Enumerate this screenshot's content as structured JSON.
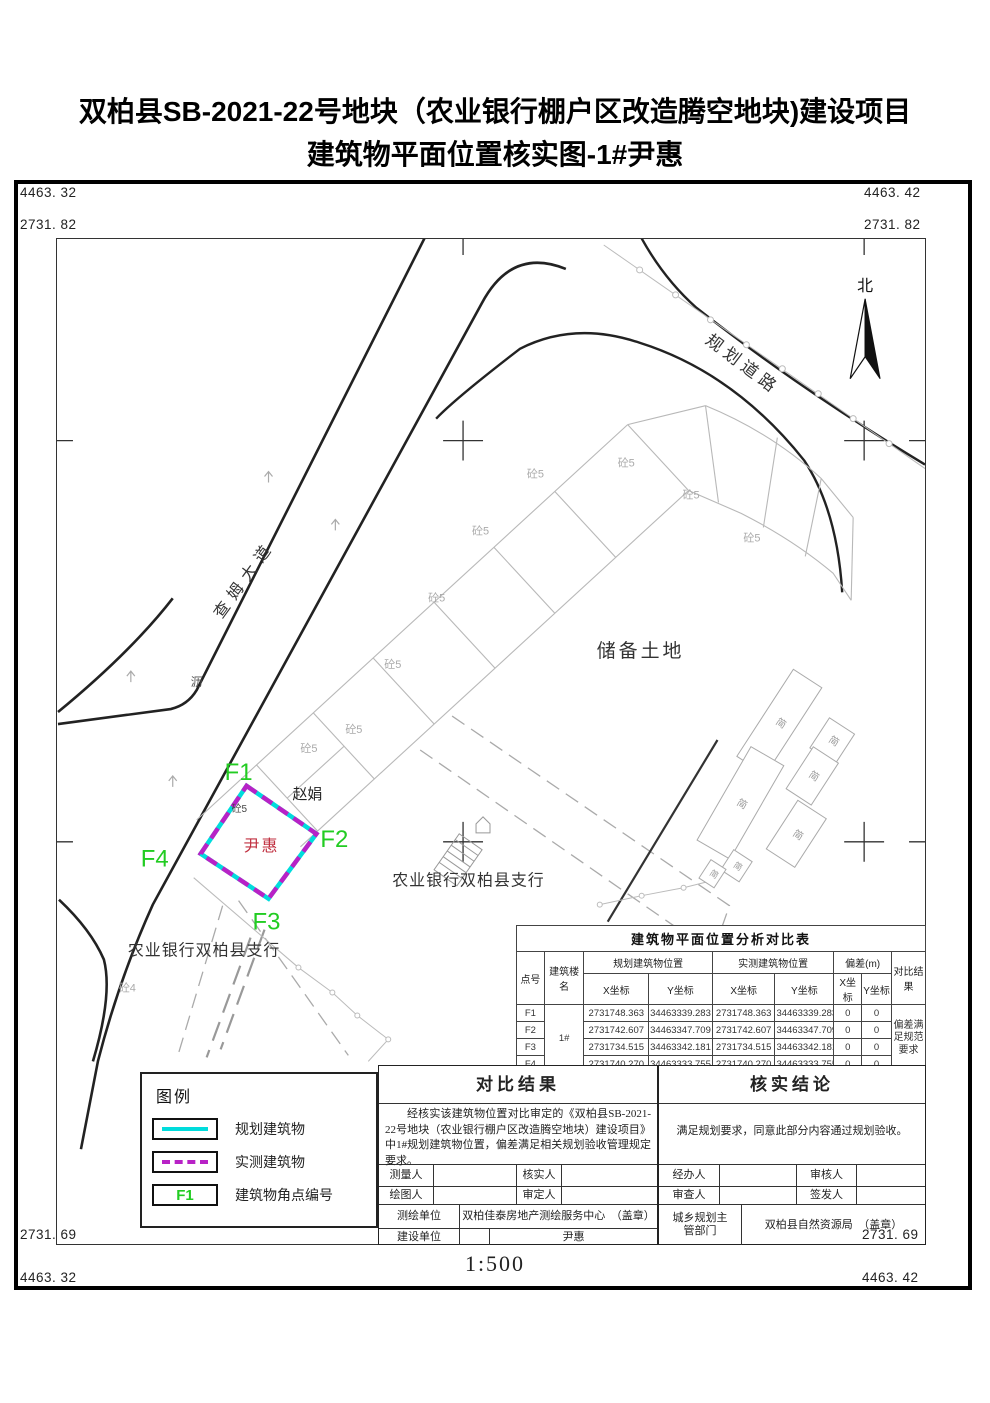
{
  "title": {
    "line1": "双柏县SB-2021-22号地块（农业银行棚户区改造腾空地块)建设项目",
    "line2": "建筑物平面位置核实图-1#尹惠"
  },
  "frame_coords": {
    "tl_a": "4463. 32",
    "tl_b": "2731. 82",
    "tr_a": "4463. 42",
    "tr_b": "2731. 82",
    "bl_a": "2731. 69",
    "bl_b": "4463. 32",
    "br_a": "2731. 69",
    "br_b": "4463. 42"
  },
  "map": {
    "north": "北",
    "chamu_road": "查姆大道",
    "planned_road": "规划道路",
    "li": "沥",
    "reserved_land": "储备土地",
    "bank_upper": "农业银行双柏县支行",
    "bank_lower": "农业银行双柏县支行",
    "zhaojuan": "赵娟",
    "yinhui": "尹惠",
    "tong5": "砼5",
    "tong4": "砼4",
    "jian": "简",
    "f1": "F1",
    "f2": "F2",
    "f3": "F3",
    "f4": "F4"
  },
  "analysis_table": {
    "title": "建筑物平面位置分析对比表",
    "headers": {
      "point": "点号",
      "building": "建筑楼名",
      "planned": "规划建筑物位置",
      "measured": "实测建筑物位置",
      "deviation": "偏差(m)",
      "result": "对比结果",
      "x": "X坐标",
      "y": "Y坐标"
    },
    "building_name": "1#",
    "result_text": "偏差满足规范要求",
    "rows": [
      {
        "point": "F1",
        "px": "2731748.363",
        "py": "34463339.283",
        "mx": "2731748.363",
        "my": "34463339.283",
        "dx": "0",
        "dy": "0"
      },
      {
        "point": "F2",
        "px": "2731742.607",
        "py": "34463347.709",
        "mx": "2731742.607",
        "my": "34463347.709",
        "dx": "0",
        "dy": "0"
      },
      {
        "point": "F3",
        "px": "2731734.515",
        "py": "34463342.181",
        "mx": "2731734.515",
        "my": "34463342.181",
        "dx": "0",
        "dy": "0"
      },
      {
        "point": "F4",
        "px": "2731740.270",
        "py": "34463333.755",
        "mx": "2731740.270",
        "my": "34463333.755",
        "dx": "0",
        "dy": "0"
      }
    ]
  },
  "legend": {
    "title": "图例",
    "planned_label": "规划建筑物",
    "measured_label": "实测建筑物",
    "corner_symbol": "F1",
    "corner_label": "建筑物角点编号"
  },
  "result_section": {
    "title": "对比结果",
    "body": "经核实该建筑物位置对比审定的《双柏县SB-2021-22号地块（农业银行棚户区改造腾空地块）建设项目》中1#规划建筑物位置，偏差满足相关规划验收管理规定要求。"
  },
  "conclusion_section": {
    "title": "核实结论",
    "body": "满足规划要求，同意此部分内容通过规划验收。"
  },
  "signoff": {
    "surveyor": "测量人",
    "verifier": "核实人",
    "drafter": "绘图人",
    "approver": "审定人",
    "handler": "经办人",
    "reviewer": "审核人",
    "examiner": "审查人",
    "issuer": "签发人",
    "survey_unit_label": "测绘单位",
    "survey_unit": "双柏佳泰房地产测绘服务中心　（盖章）",
    "construction_unit_label": "建设单位",
    "construction_unit": "尹惠",
    "planning_dept_label": "城乡规划主管部门",
    "planning_dept": "双柏县自然资源局　（盖章）"
  },
  "scale": {
    "label": "1:500"
  },
  "colors": {
    "planned_line": "#00dcdc",
    "measured_line": "#b822c6",
    "corner_green": "#22cc22",
    "owner_red": "#c03040"
  }
}
